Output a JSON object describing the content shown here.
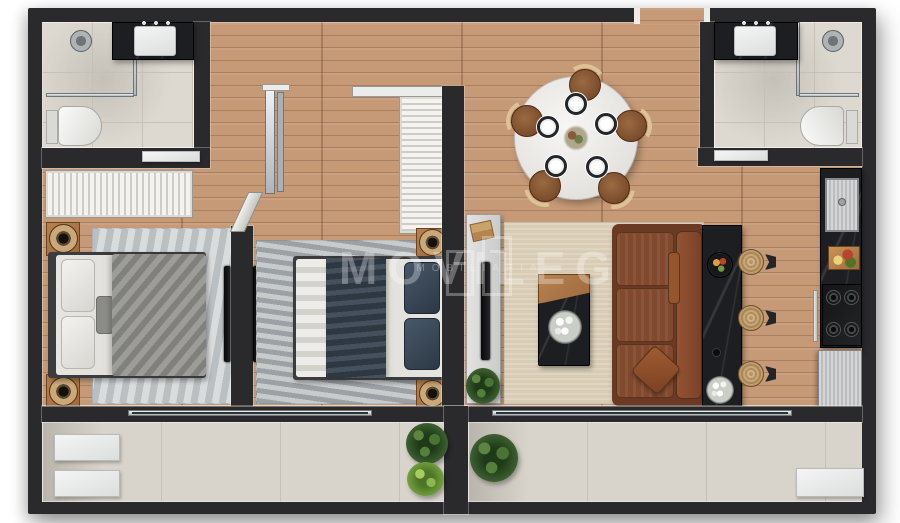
{
  "watermark": {
    "brand": "MOVILEG",
    "tagline": "MOBILIARIA",
    "icon": "building-outline-icon"
  },
  "colors": {
    "wall": "#2a2a2d",
    "trim": "#ececea",
    "wood": "#c69a77",
    "tile": "#ddd9d0",
    "tile_line": "#c6c0b6",
    "balcony": "#d8d4cb",
    "rug_gray": "#ccd0d2",
    "rug_dark": "#b7bcbe",
    "rug_beige": "#d8ccb4",
    "bed_white": "#e7e5e0",
    "blanket_gray": "#8f8e8a",
    "navy": "#35414e",
    "sofa": "#81492e",
    "sofa_dark": "#6b3a24",
    "marble": "#1d1e21",
    "accent_wood": "#a06a3e",
    "stainless": "#c6c8ca",
    "console": "#cbcbcb",
    "plant_dark": "#3d5f31",
    "plant_light": "#77a33f",
    "glass": "#ccd3d6",
    "watermark": "rgba(255,255,255,0.30)"
  }
}
